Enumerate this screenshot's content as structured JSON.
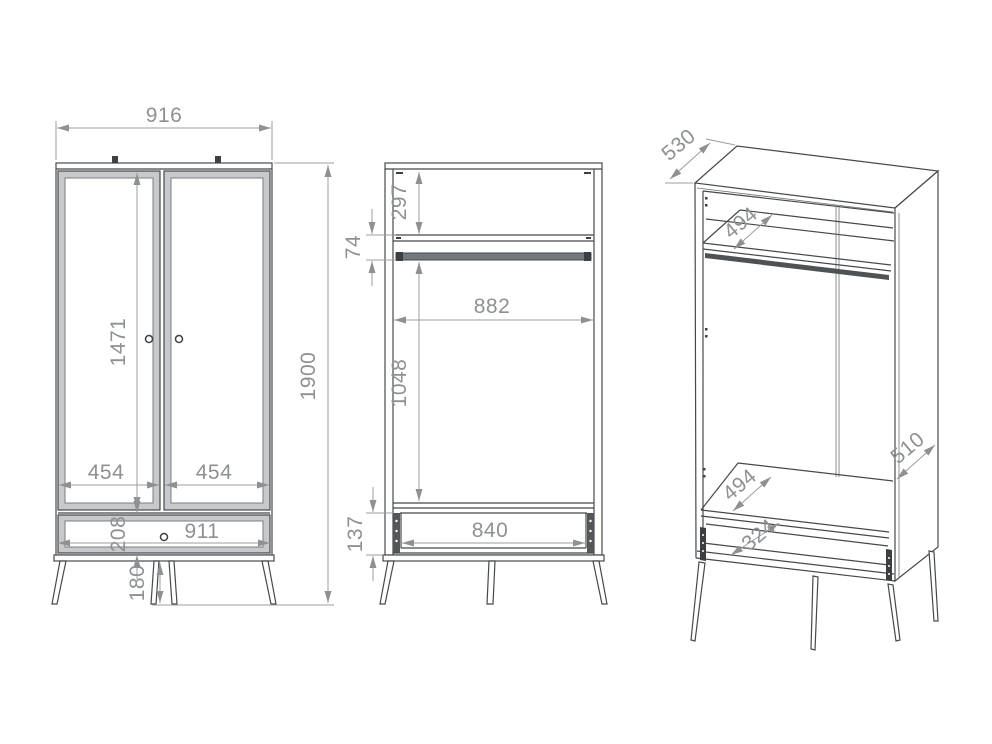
{
  "drawing": {
    "front_view": {
      "width": "916",
      "door_height": "1471",
      "left_door_width": "454",
      "right_door_width": "454",
      "overall_height": "1900",
      "drawer_front_height": "208",
      "drawer_width": "911",
      "leg_height": "180"
    },
    "interior_view": {
      "top_shelf_offset": "297",
      "rod_clearance": "74",
      "interior_width": "882",
      "hanging_space_height": "1048",
      "drawer_inner_height": "137",
      "drawer_inner_width": "840"
    },
    "perspective_view": {
      "top_depth": "530",
      "upper_shelf_depth": "494",
      "side_depth": "510",
      "lower_shelf_depth": "494",
      "drawer_depth": "324"
    },
    "colors": {
      "outline": "#45494b",
      "dimension": "#8d9193",
      "shading": "#c6cacc",
      "accent_dark": "#3c4042"
    }
  }
}
